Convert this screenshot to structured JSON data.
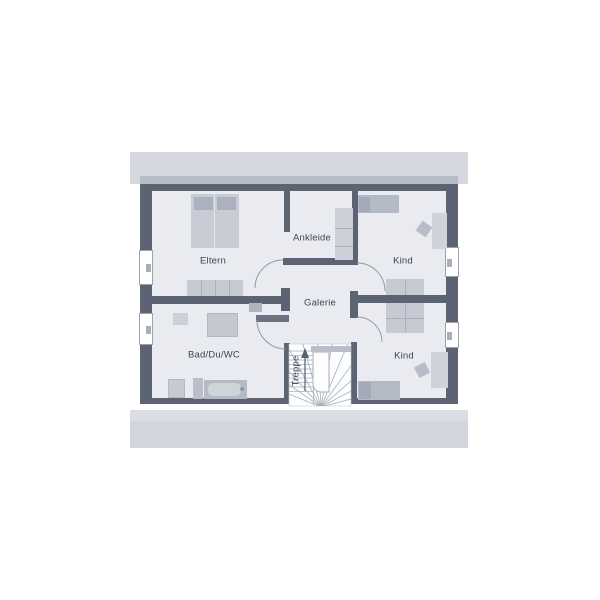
{
  "plan": {
    "rooms": [
      {
        "key": "eltern",
        "label": "Eltern"
      },
      {
        "key": "ankleide",
        "label": "Ankleide"
      },
      {
        "key": "kind-top",
        "label": "Kind"
      },
      {
        "key": "galerie",
        "label": "Galerie"
      },
      {
        "key": "bad-du-wc",
        "label": "Bad/Du/WC"
      },
      {
        "key": "kind-bottom",
        "label": "Kind"
      },
      {
        "key": "treppe",
        "label": "Treppe"
      }
    ],
    "colors": {
      "wall": "#5c6474",
      "roof_band": "#d4d7de",
      "roof_band_dark": "#b7bbc6",
      "floor": "#e9ebf0",
      "stair_floor": "#fcfdfe",
      "furniture_light": "#c8ccd5",
      "furniture_medium": "#b3b9c5",
      "furniture_dark": "#a2a9b7",
      "door_arc": "#9298a4",
      "label_text": "#3d4452"
    }
  }
}
